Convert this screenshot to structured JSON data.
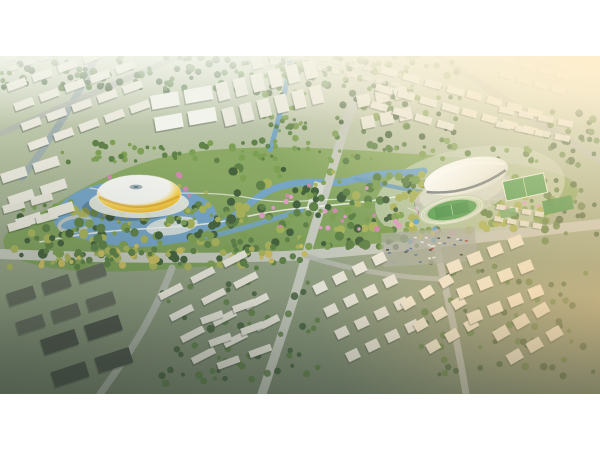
{
  "frame": {
    "width": 600,
    "height": 450,
    "bg": "#ffffff",
    "image": {
      "x": 0,
      "y": 56,
      "width": 600,
      "height": 338
    }
  },
  "palette": {
    "ground_top": "#d3d8c5",
    "ground_mid": "#b0bc9c",
    "ground_low": "#96a487",
    "ground_dark": "#7d8a72",
    "haze_white": "#f4f6ec",
    "pure_white": "#ffffff",
    "road": "#c6cabf",
    "road_minor": "#b5bab0",
    "park_green": "#7d9e5c",
    "park_green2": "#8dab66",
    "water": "#76a5c6",
    "water_deep": "#6a9abd",
    "river_gray": "#9cadb2",
    "tree_dark": "#46633f",
    "tree_mid": "#5f8249",
    "tree_light": "#7ea055",
    "tree_yellow": "#a9b35c",
    "tree_gold": "#c9bd62",
    "blossom": "#dd9ec4",
    "blossom2": "#cf8ab1",
    "play_blue": "#5aa7d6",
    "play_yellow": "#e0cf5c",
    "building_white": "#eae8dd",
    "building_warm": "#f1e9d4",
    "building_shadow": "#39443b",
    "industrial_dark": "#666d60",
    "industrial_darker": "#4f564c",
    "stadium_yellow": "#e9b42e",
    "stadium_yellow_hi": "#f6d254",
    "stadium_yellow_deep": "#d2971f",
    "stadium_white": "#f4f5f0",
    "stadium_oculus": "#9fb2b8",
    "stadium_oculus_dark": "#6c7f86",
    "arena_white": "#f1f3ec",
    "arena_shade": "#d6dccd",
    "arena_dark": "#4d5a63",
    "stands_gray": "#c9cfc0",
    "track_lanes": "#c2d2b2",
    "lane_white": "#eef3e6",
    "pitch_green": "#4f9e52",
    "pitch_green_dark": "#3f8f47",
    "court_green": "#6aa86a",
    "sports_ground": "#cdd6bf",
    "plaza": "#e9ebe1",
    "path_white": "#f0f2ea",
    "bridge_gray": "#d4d8cc",
    "parking_gray": "#a9aea4",
    "car_white": "#e6e8e4",
    "car_red": "#b0554d",
    "car_blue": "#5a77a0",
    "car_gray": "#9aa0a0",
    "car_dark": "#474d4d",
    "sun_glow": "#ffeecb",
    "sun_warm": "#f2c584",
    "vignette": "#29342c"
  },
  "scene": {
    "water": [
      {
        "name": "river-west",
        "d": "M96,0 C82,34 56,76 22,122",
        "stroke": "river_gray",
        "w": 7,
        "op": 0.8
      },
      {
        "name": "stadium-lake",
        "d": "M55,156 C70,130 108,122 150,127 C192,132 222,146 216,164 C206,185 158,195 113,189 C78,184 46,176 55,156 Z",
        "fill": "water"
      },
      {
        "name": "river-main",
        "d": "M212,172 C242,162 252,136 286,129 C316,122 332,131 356,123 C380,115 398,119 424,115",
        "stroke": "water",
        "w": 7
      },
      {
        "name": "river-south",
        "d": "M120,182 C160,188 200,184 232,175 C262,167 282,160 302,154",
        "stroke": "water",
        "w": 5,
        "op": 0.9
      },
      {
        "name": "river-east",
        "d": "M356,123 C390,130 420,137 452,140 C480,142 510,140 540,134",
        "stroke": "water_deep",
        "w": 4,
        "op": 0.85
      },
      {
        "name": "canal-north",
        "d": "M291,0 C287,28 281,58 270,94",
        "stroke": "water",
        "w": 5,
        "op": 0.95
      }
    ],
    "roads": [
      {
        "name": "road-north-south",
        "d": "M372,0 C358,38 346,64 338,94 C324,142 314,172 306,200 C294,246 276,296 262,338",
        "w": 9,
        "c": "road"
      },
      {
        "name": "road-east-west",
        "d": "M0,198 C100,202 204,204 306,199 C404,191 502,179 600,168",
        "w": 10,
        "c": "road"
      },
      {
        "name": "road-south-right",
        "d": "M436,188 C446,234 458,288 466,338",
        "w": 7,
        "c": "road_minor"
      },
      {
        "name": "road-northeast",
        "d": "M440,0 C492,36 546,72 600,104",
        "w": 7,
        "c": "road_minor",
        "op": 0.9
      },
      {
        "name": "road-northwest",
        "d": "M0,78 C60,52 122,24 180,0",
        "w": 6,
        "c": "road_minor",
        "op": 0.85
      },
      {
        "name": "road-southwest",
        "d": "M100,338 C122,308 152,266 172,212",
        "w": 7,
        "c": "road_minor",
        "op": 0.9
      },
      {
        "name": "road-park-south",
        "d": "M306,200 C350,214 394,221 440,223",
        "w": 5,
        "c": "road_minor",
        "op": 0.85
      }
    ],
    "walkways": [
      {
        "name": "park-path-a",
        "d": "M40,186 C120,168 180,176 240,162 C300,148 340,152 400,140 C450,131 500,129 545,131",
        "w": 1.6,
        "op": 0.85
      },
      {
        "name": "park-path-b",
        "d": "M90,132 C140,142 200,132 250,142 C300,152 330,137 360,147",
        "w": 1.2,
        "op": 0.7
      },
      {
        "name": "park-path-c",
        "d": "M408,152 C430,162 452,166 472,158",
        "w": 1.2,
        "op": 0.7
      }
    ],
    "treeBands": [
      {
        "name": "tree-band-topleft",
        "x": 0,
        "y": 0,
        "w": 150,
        "h": 32,
        "n": 55,
        "rmin": 2,
        "rmax": 4,
        "colors": [
          "tree_dark",
          "tree_mid"
        ],
        "op": 0.95,
        "seed": 11
      },
      {
        "name": "tree-band-topmid",
        "x": 155,
        "y": 0,
        "w": 180,
        "h": 40,
        "n": 60,
        "rmin": 2,
        "rmax": 4,
        "colors": [
          "tree_mid",
          "tree_dark"
        ],
        "op": 0.9,
        "seed": 12
      },
      {
        "name": "tree-band-canal-verge",
        "x": 262,
        "y": 0,
        "w": 44,
        "h": 94,
        "n": 45,
        "rmin": 1.5,
        "rmax": 3.5,
        "colors": [
          "tree_mid",
          "tree_light"
        ],
        "op": 0.9,
        "seed": 13
      },
      {
        "name": "tree-band-ne-boulevard",
        "x": 335,
        "y": 0,
        "w": 125,
        "h": 92,
        "n": 85,
        "rmin": 2,
        "rmax": 4,
        "colors": [
          "tree_mid",
          "tree_light",
          "tree_dark"
        ],
        "op": 0.92,
        "seed": 14
      },
      {
        "name": "tree-band-park-top",
        "x": 62,
        "y": 86,
        "w": 480,
        "h": 20,
        "n": 80,
        "rmin": 1.5,
        "rmax": 3.5,
        "colors": [
          "tree_mid",
          "tree_light"
        ],
        "op": 1,
        "seed": 15
      },
      {
        "name": "tree-band-park-left",
        "x": 18,
        "y": 148,
        "w": 230,
        "h": 62,
        "n": 140,
        "rmin": 2,
        "rmax": 5,
        "colors": [
          "tree_dark",
          "tree_mid",
          "tree_light",
          "tree_yellow"
        ],
        "op": 1,
        "seed": 16
      },
      {
        "name": "tree-band-lake-islands",
        "x": 70,
        "y": 126,
        "w": 150,
        "h": 46,
        "n": 40,
        "rmin": 1.5,
        "rmax": 3,
        "colors": [
          "tree_light",
          "tree_yellow"
        ],
        "op": 1,
        "seed": 17
      },
      {
        "name": "tree-band-park-mid",
        "x": 228,
        "y": 112,
        "w": 195,
        "h": 80,
        "n": 130,
        "rmin": 2,
        "rmax": 5,
        "colors": [
          "tree_mid",
          "tree_light",
          "tree_yellow",
          "tree_dark"
        ],
        "op": 1,
        "seed": 18
      },
      {
        "name": "tree-band-park-right",
        "x": 392,
        "y": 118,
        "w": 168,
        "h": 58,
        "n": 100,
        "rmin": 2,
        "rmax": 4.5,
        "colors": [
          "tree_mid",
          "tree_light",
          "tree_yellow"
        ],
        "op": 1,
        "seed": 19
      },
      {
        "name": "tree-band-avenue-south",
        "x": 0,
        "y": 190,
        "w": 305,
        "h": 22,
        "n": 70,
        "rmin": 2,
        "rmax": 4,
        "colors": [
          "tree_yellow",
          "tree_gold",
          "tree_mid"
        ],
        "op": 1,
        "seed": 20
      },
      {
        "name": "tree-band-right-edge",
        "x": 545,
        "y": 55,
        "w": 55,
        "h": 130,
        "n": 45,
        "rmin": 2,
        "rmax": 4,
        "colors": [
          "tree_mid",
          "tree_dark"
        ],
        "op": 0.9,
        "seed": 21
      },
      {
        "name": "tree-band-south-mid",
        "x": 160,
        "y": 225,
        "w": 160,
        "h": 105,
        "n": 55,
        "rmin": 2,
        "rmax": 4,
        "colors": [
          "tree_dark",
          "tree_mid"
        ],
        "op": 0.85,
        "seed": 22
      },
      {
        "name": "tree-band-south-right",
        "x": 420,
        "y": 205,
        "w": 175,
        "h": 125,
        "n": 60,
        "rmin": 2,
        "rmax": 4,
        "colors": [
          "tree_dark",
          "tree_mid"
        ],
        "op": 0.8,
        "seed": 23
      },
      {
        "name": "blossom-band-left",
        "x": 95,
        "y": 118,
        "w": 95,
        "h": 28,
        "n": 12,
        "rmin": 1.5,
        "rmax": 2.8,
        "colors": [
          "blossom",
          "blossom2"
        ],
        "op": 1,
        "seed": 24
      },
      {
        "name": "blossom-band-mid",
        "x": 255,
        "y": 128,
        "w": 170,
        "h": 46,
        "n": 22,
        "rmin": 1.5,
        "rmax": 3,
        "colors": [
          "blossom",
          "blossom2"
        ],
        "op": 1,
        "seed": 25
      },
      {
        "name": "blossom-band-right",
        "x": 430,
        "y": 118,
        "w": 120,
        "h": 36,
        "n": 16,
        "rmin": 1.5,
        "rmax": 2.8,
        "colors": [
          "blossom",
          "blossom2"
        ],
        "op": 1,
        "seed": 26
      },
      {
        "name": "playground-features",
        "x": 408,
        "y": 160,
        "w": 48,
        "h": 26,
        "n": 14,
        "rmin": 1.5,
        "rmax": 3,
        "colors": [
          "play_blue",
          "blossom",
          "play_yellow"
        ],
        "op": 1,
        "seed": 27
      }
    ],
    "clusters": [
      {
        "name": "far-city-west",
        "x": 5,
        "y": 2,
        "cols": 8,
        "rows": 2,
        "bw": 11,
        "bh": 4,
        "gx": 5,
        "gy": 6,
        "rot": -18,
        "fill": "building_white",
        "op": 0.65
      },
      {
        "name": "far-city-east",
        "x": 320,
        "y": 0,
        "cols": 7,
        "rows": 2,
        "bw": 10,
        "bh": 4,
        "gx": 5,
        "gy": 6,
        "rot": 12,
        "fill": "building_white",
        "op": 0.6
      },
      {
        "name": "district-topleft",
        "x": 6,
        "y": 28,
        "cols": 5,
        "rows": 4,
        "bw": 20,
        "bh": 8,
        "gx": 7,
        "gy": 13,
        "rot": -20,
        "fill": "building_white",
        "op": 1
      },
      {
        "name": "district-topleft-slabs",
        "x": 0,
        "y": 118,
        "cols": 2,
        "rows": 3,
        "bw": 26,
        "bh": 10,
        "gx": 8,
        "gy": 14,
        "rot": -18,
        "fill": "building_white",
        "op": 1
      },
      {
        "name": "exhibition-halls",
        "x": 150,
        "y": 40,
        "cols": 2,
        "rows": 2,
        "bw": 28,
        "bh": 14,
        "gx": 6,
        "gy": 8,
        "rot": -10,
        "fill": "arena_white",
        "op": 1
      },
      {
        "name": "towers-topmid",
        "x": 215,
        "y": 28,
        "cols": 6,
        "rows": 2,
        "bw": 12,
        "bh": 18,
        "gx": 6,
        "gy": 8,
        "rot": -14,
        "fill": "building_white",
        "op": 1
      },
      {
        "name": "towers-topmid-back",
        "x": 250,
        "y": 0,
        "cols": 4,
        "rows": 1,
        "bw": 11,
        "bh": 14,
        "gx": 7,
        "gy": 0,
        "rot": -14,
        "fill": "building_white",
        "op": 0.85
      },
      {
        "name": "towers-mid-right",
        "x": 356,
        "y": 40,
        "cols": 3,
        "rows": 2,
        "bw": 13,
        "bh": 12,
        "gx": 6,
        "gy": 10,
        "rot": -12,
        "fill": "building_white",
        "op": 0.95
      },
      {
        "name": "district-topright-a",
        "x": 382,
        "y": 10,
        "cols": 4,
        "rows": 3,
        "bw": 17,
        "bh": 7,
        "gx": 6,
        "gy": 11,
        "rot": 16,
        "fill": "building_white",
        "op": 0.95
      },
      {
        "name": "district-topright-b",
        "x": 468,
        "y": 34,
        "cols": 4,
        "rows": 2,
        "bw": 15,
        "bh": 7,
        "gx": 6,
        "gy": 11,
        "rot": 16,
        "fill": "building_warm",
        "op": 0.9
      },
      {
        "name": "district-topright-c",
        "x": 505,
        "y": 0,
        "cols": 4,
        "rows": 2,
        "bw": 13,
        "bh": 6,
        "gx": 5,
        "gy": 9,
        "rot": 16,
        "fill": "building_warm",
        "op": 0.75
      },
      {
        "name": "district-right-mid",
        "x": 500,
        "y": 50,
        "cols": 4,
        "rows": 2,
        "bw": 15,
        "bh": 6,
        "gx": 5,
        "gy": 9,
        "rot": 12,
        "fill": "building_white",
        "op": 0.9
      },
      {
        "name": "district-left-mid",
        "x": 2,
        "y": 150,
        "cols": 2,
        "rows": 2,
        "bw": 22,
        "bh": 8,
        "gx": 7,
        "gy": 11,
        "rot": -16,
        "fill": "building_white",
        "op": 0.95
      },
      {
        "name": "industrial-southwest",
        "x": 6,
        "y": 238,
        "cols": 3,
        "rows": 2,
        "bw": 28,
        "bh": 13,
        "gx": 9,
        "gy": 17,
        "rot": -18,
        "fill": "industrial_dark",
        "op": 1
      },
      {
        "name": "industrial-southwest-2",
        "x": 40,
        "y": 284,
        "cols": 2,
        "rows": 2,
        "bw": 36,
        "bh": 16,
        "gx": 10,
        "gy": 18,
        "rot": -18,
        "fill": "industrial_darker",
        "op": 1
      },
      {
        "name": "rowhouses-south-a",
        "x": 158,
        "y": 238,
        "cols": 3,
        "rows": 4,
        "bw": 25,
        "bh": 7,
        "gx": 11,
        "gy": 17,
        "rot": -27,
        "fill": "building_white",
        "op": 1
      },
      {
        "name": "rowhouses-south-b",
        "x": 200,
        "y": 262,
        "cols": 2,
        "rows": 3,
        "bw": 23,
        "bh": 7,
        "gx": 11,
        "gy": 17,
        "rot": -20,
        "fill": "building_white",
        "op": 1
      },
      {
        "name": "towers-south-a",
        "x": 312,
        "y": 230,
        "cols": 4,
        "rows": 4,
        "bw": 13,
        "bh": 10,
        "gx": 9,
        "gy": 15,
        "rot": -26,
        "fill": "building_white",
        "op": 1
      },
      {
        "name": "towers-south-b",
        "x": 400,
        "y": 246,
        "cols": 3,
        "rows": 3,
        "bw": 13,
        "bh": 10,
        "gx": 9,
        "gy": 15,
        "rot": -30,
        "fill": "building_warm",
        "op": 1
      },
      {
        "name": "towers-southeast",
        "x": 446,
        "y": 208,
        "cols": 4,
        "rows": 3,
        "bw": 14,
        "bh": 11,
        "gx": 8,
        "gy": 16,
        "rot": -22,
        "fill": "building_warm",
        "op": 1
      },
      {
        "name": "towers-southeast-2",
        "x": 492,
        "y": 276,
        "cols": 3,
        "rows": 2,
        "bw": 15,
        "bh": 11,
        "gx": 8,
        "gy": 16,
        "rot": -30,
        "fill": "building_warm",
        "op": 0.95
      },
      {
        "name": "village-right",
        "x": 497,
        "y": 148,
        "cols": 4,
        "rows": 2,
        "bw": 9,
        "bh": 5,
        "gx": 4,
        "gy": 7,
        "rot": 10,
        "fill": "building_white",
        "op": 0.9
      }
    ],
    "cars": {
      "name": "parking-cars",
      "x": 386,
      "y": 180,
      "w": 84,
      "h": 26,
      "n": 28,
      "cw": 3,
      "ch": 1.6,
      "colors": [
        "car_white",
        "car_red",
        "car_blue",
        "car_gray",
        "car_dark"
      ],
      "seed": 31
    }
  }
}
